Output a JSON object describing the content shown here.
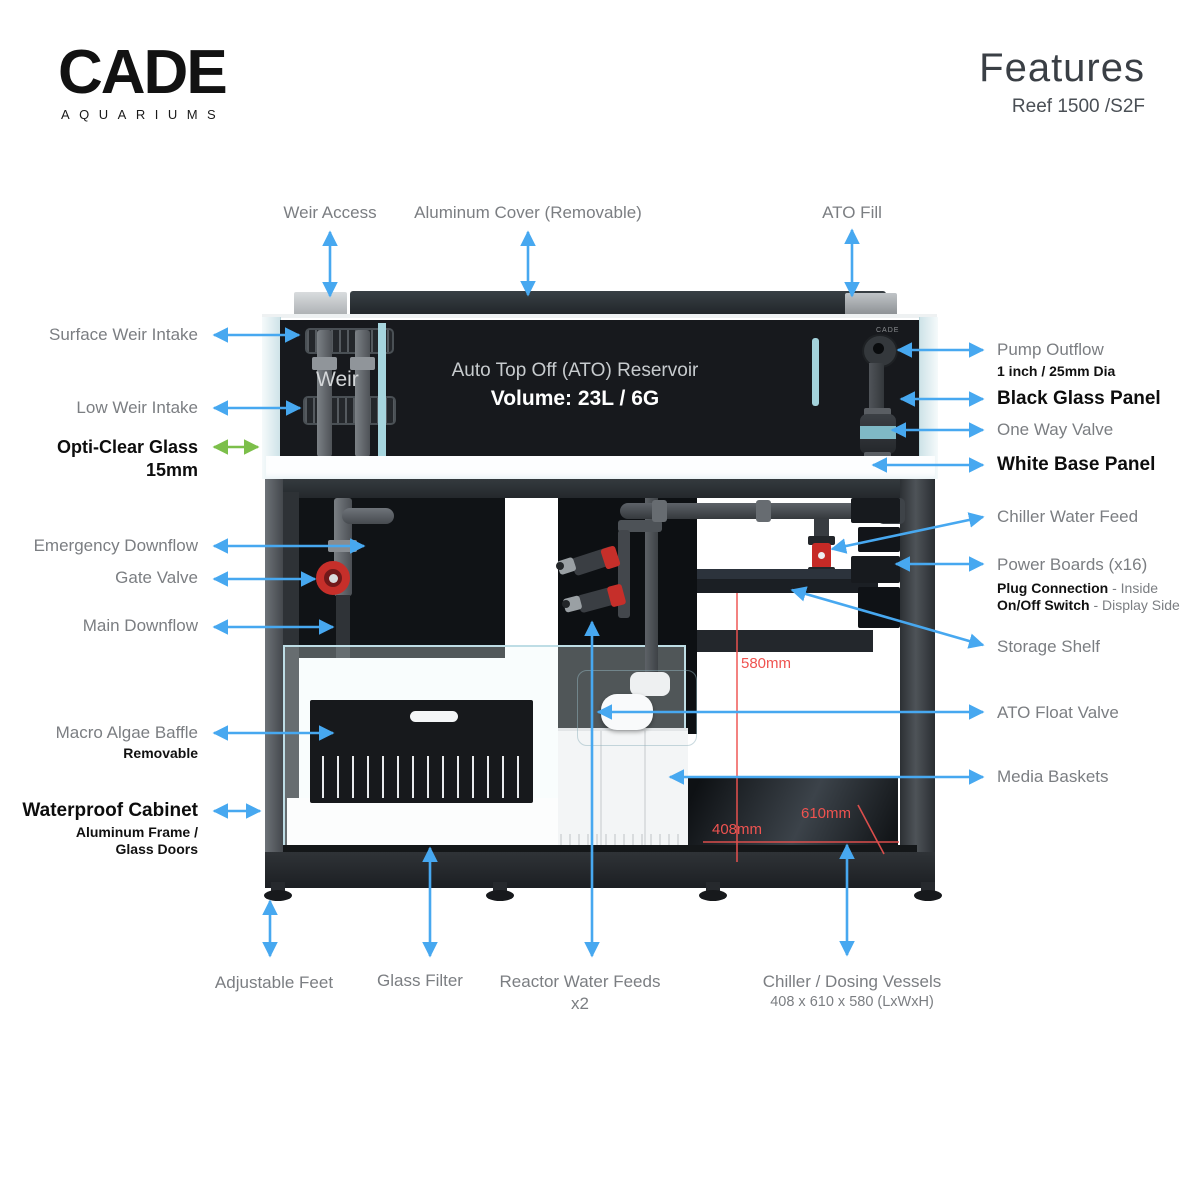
{
  "header": {
    "logo_main": "CADE",
    "logo_sub": "AQUARIUMS",
    "title": "Features",
    "subtitle": "Reef 1500 /S2F"
  },
  "tank": {
    "weir_label": "Weir",
    "ato_title": "Auto Top Off (ATO) Reservoir",
    "ato_volume": "Volume: 23L / 6G",
    "brand_mark": "CADE"
  },
  "labels": {
    "top": [
      {
        "text": "Weir Access"
      },
      {
        "text": "Aluminum Cover (Removable)"
      },
      {
        "text": "ATO Fill"
      }
    ],
    "left": [
      {
        "text": "Surface Weir Intake"
      },
      {
        "text": "Low Weir Intake"
      },
      {
        "text": "Opti-Clear Glass",
        "line2": "15mm"
      },
      {
        "text": "Emergency Downflow"
      },
      {
        "text": "Gate Valve"
      },
      {
        "text": "Main Downflow"
      },
      {
        "text": "Macro Algae Baffle",
        "sub": "Removable"
      },
      {
        "text": "Waterproof Cabinet",
        "sub1": "Aluminum Frame /",
        "sub2": "Glass Doors"
      }
    ],
    "right": [
      {
        "text": "Pump Outflow",
        "sub": "1 inch / 25mm Dia"
      },
      {
        "text": "Black Glass Panel"
      },
      {
        "text": "One Way Valve"
      },
      {
        "text": "White Base Panel"
      },
      {
        "text": "Chiller Water Feed"
      },
      {
        "text": "Power Boards (x16)",
        "sub1_bold": "Plug Connection",
        "sub1_rest": " - Inside",
        "sub2_bold": "On/Off Switch",
        "sub2_rest": " - Display Side"
      },
      {
        "text": "Storage Shelf"
      },
      {
        "text": "ATO Float Valve"
      },
      {
        "text": "Media Baskets"
      }
    ],
    "bottom": [
      {
        "text": "Adjustable Feet"
      },
      {
        "text": "Glass Filter"
      },
      {
        "text": "Reactor Water Feeds",
        "sub": "x2"
      },
      {
        "text": "Chiller / Dosing Vessels",
        "sub": "408 x 610 x 580 (LxWxH)"
      }
    ]
  },
  "dimensions": {
    "height": "580mm",
    "length": "408mm",
    "width": "610mm"
  },
  "colors": {
    "arrow_blue": "#47a8f0",
    "arrow_green": "#7cbf4a",
    "dimension_red": "#ef5350",
    "label_gray": "#7b7e82",
    "label_black": "#0d0d0d"
  }
}
